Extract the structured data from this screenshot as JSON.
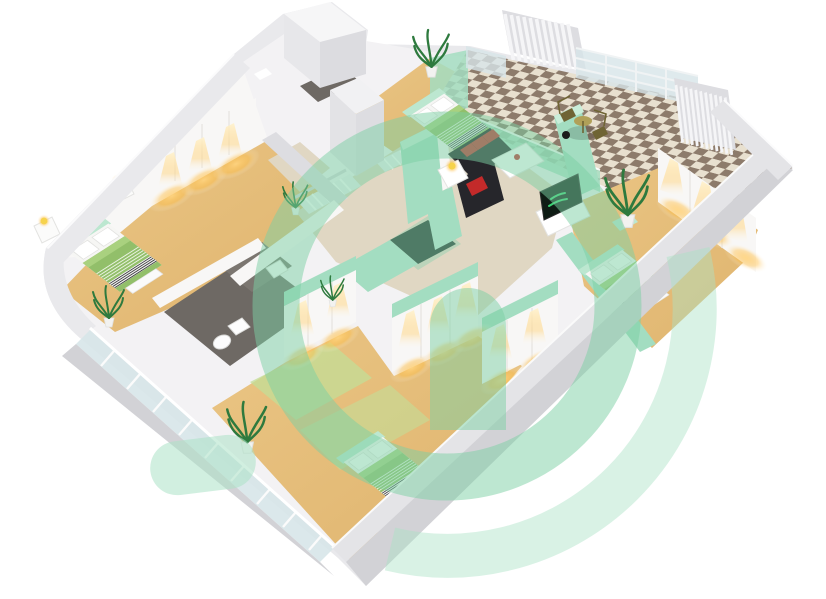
{
  "image": {
    "width": 826,
    "height": 599,
    "background": "#ffffff"
  },
  "scene": {
    "kind": "isometric-3d-floor-plan-render",
    "rooms": [
      {
        "name": "master-bedroom",
        "floor": "wood"
      },
      {
        "name": "bedroom-2",
        "floor": "wood"
      },
      {
        "name": "bedroom-3",
        "floor": "wood"
      },
      {
        "name": "bedroom-4",
        "floor": "wood-green"
      },
      {
        "name": "bathroom-1",
        "floor": "dark-tile"
      },
      {
        "name": "bathroom-2",
        "floor": "dark-tile"
      },
      {
        "name": "hallway-living",
        "floor": "beige"
      },
      {
        "name": "balcony-terrace",
        "floor": "checker-tile"
      },
      {
        "name": "staircase",
        "floor": "white"
      }
    ],
    "furniture": [
      "double-bed-green",
      "single-bed-green",
      "wardrobe-downlights",
      "black-sofa-red-cushions",
      "black-armchair",
      "white-coffee-table",
      "white-side-table-lamp",
      "tv-console-green-screen",
      "bistro-table-two-chairs",
      "toilet",
      "vanity-counter",
      "nightstand-lamps",
      "potted-palms"
    ]
  },
  "palette": {
    "bg": "#ffffff",
    "wall_outer": "#e9e9ec",
    "wall_mass": "#f3f2f4",
    "wall_face": "#f8f7f6",
    "wall_band_mid": "#e4e4e7",
    "wall_band_dark": "#d2d2d6",
    "wall_shade": "#dddde1",
    "wood": "#dfb46e",
    "wood_light": "#eac584",
    "beige": "#e0d7c3",
    "mint": "#a3ddc1",
    "mint_light": "#c9edd9",
    "mint_deep": "#8fd0b0",
    "glass": "#d7e5e9",
    "dark_floor": "#6e6964",
    "dark_floor2": "#7b7670",
    "checker_cream": "#e8e0cf",
    "checker_brown": "#8d7b6b",
    "shaft_dark": "#1d362a",
    "bed_green": "#92bf6a",
    "bed_green_light": "#a9d17f",
    "bed_mint": "#bce7d0",
    "stripe_dark": "#34343a",
    "white": "#fcfcfc",
    "sofa_black": "#26262b",
    "cushion_red": "#c32a2a",
    "tv_screen": "#0e1c14",
    "tv_logo": "#3bd273",
    "glow_core": "#ffd480",
    "glow_mid": "#ffc14d",
    "lamp": "#f6d34c",
    "olive": "#b0a058",
    "olive_dark": "#6f6434",
    "plant": "#2e7a3e",
    "grass": "#c3dd97"
  },
  "watermark": {
    "color": "#7ccfa3",
    "color_light": "#abe2c6",
    "opacity": 0.5
  },
  "tv": {
    "screen_color": "#0e1c14",
    "logo_color": "#3bd273"
  }
}
